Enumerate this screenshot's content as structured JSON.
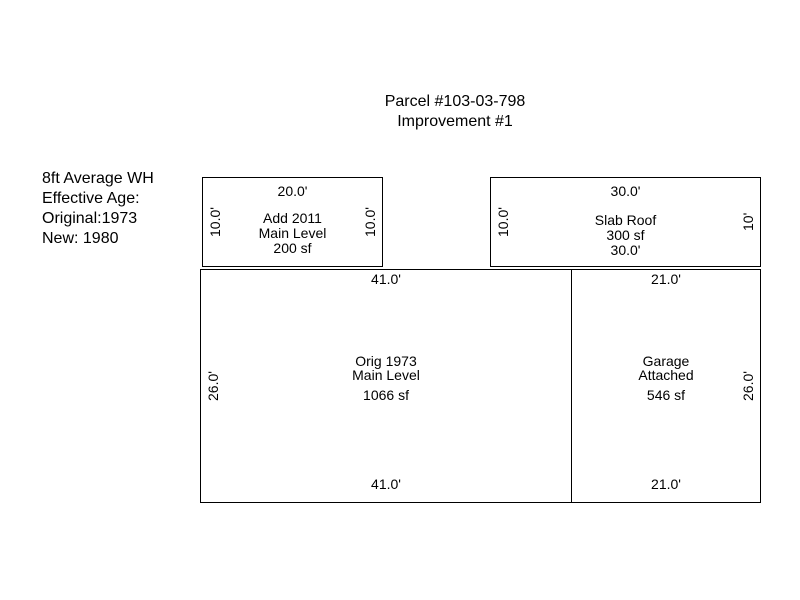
{
  "page": {
    "background": "#ffffff",
    "line_color": "#000000",
    "text_color": "#000000"
  },
  "header": {
    "parcel": "Parcel #103-03-798",
    "improvement": "Improvement #1"
  },
  "info_panel": {
    "wall_height": "8ft Average WH",
    "effective_age_label": "Effective Age:",
    "original_year": "Original:1973",
    "new_year": "New: 1980"
  },
  "sketch": {
    "boxes": [
      {
        "name": "add-2011",
        "dim_top": "20.0'",
        "dim_left": "10.0'",
        "dim_right": "10.0'",
        "lines": [
          "Add 2011",
          "Main Level",
          "200 sf"
        ]
      },
      {
        "name": "slab-roof",
        "dim_top": "30.0'",
        "dim_left": "10.0'",
        "dim_right": "10'",
        "lines": [
          "Slab Roof",
          "300 sf",
          "30.0'"
        ]
      },
      {
        "name": "orig-1973-main-level",
        "dim_top": "41.0'",
        "dim_left": "26.0'",
        "dim_bottom": "41.0'",
        "lines": [
          "Orig 1973",
          "Main Level"
        ],
        "area": "1066 sf"
      },
      {
        "name": "garage-attached",
        "dim_top": "21.0'",
        "dim_right": "26.0'",
        "dim_bottom": "21.0'",
        "lines": [
          "Garage",
          "Attached"
        ],
        "area": "546 sf"
      }
    ]
  }
}
